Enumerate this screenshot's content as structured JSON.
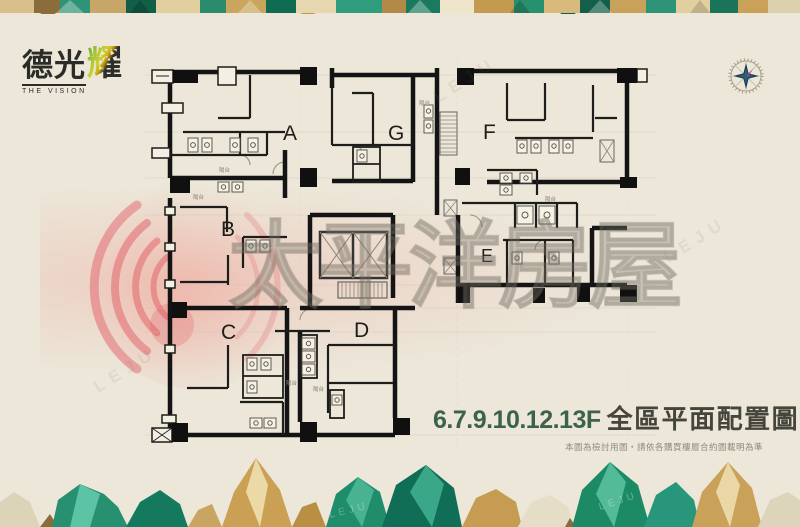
{
  "logo": {
    "brand_main": "德光",
    "brand_accent": "耀",
    "tagline": "THE VISION"
  },
  "plan": {
    "units": [
      {
        "label": "A"
      },
      {
        "label": "G"
      },
      {
        "label": "F"
      },
      {
        "label": "B"
      },
      {
        "label": "E"
      },
      {
        "label": "C"
      },
      {
        "label": "D"
      }
    ],
    "balcony_label": "陽台"
  },
  "watermark": {
    "brand_text": "太平洋房屋",
    "leju_text": "LEJU"
  },
  "caption": {
    "floors": "6.7.9.10.12.13F",
    "title": "全區平面配置圖",
    "disclaimer": "本圖為檢討用圖‧請依各購買樓層合約圖載明為準"
  },
  "colors": {
    "background": "#ece7d9",
    "wall": "#141414",
    "accent_green": "#3c624d",
    "ink": "#45453b",
    "watermark_pink": "#df4f5c",
    "gem_green": "#1f8c6b",
    "gem_gold": "#c9a158"
  }
}
